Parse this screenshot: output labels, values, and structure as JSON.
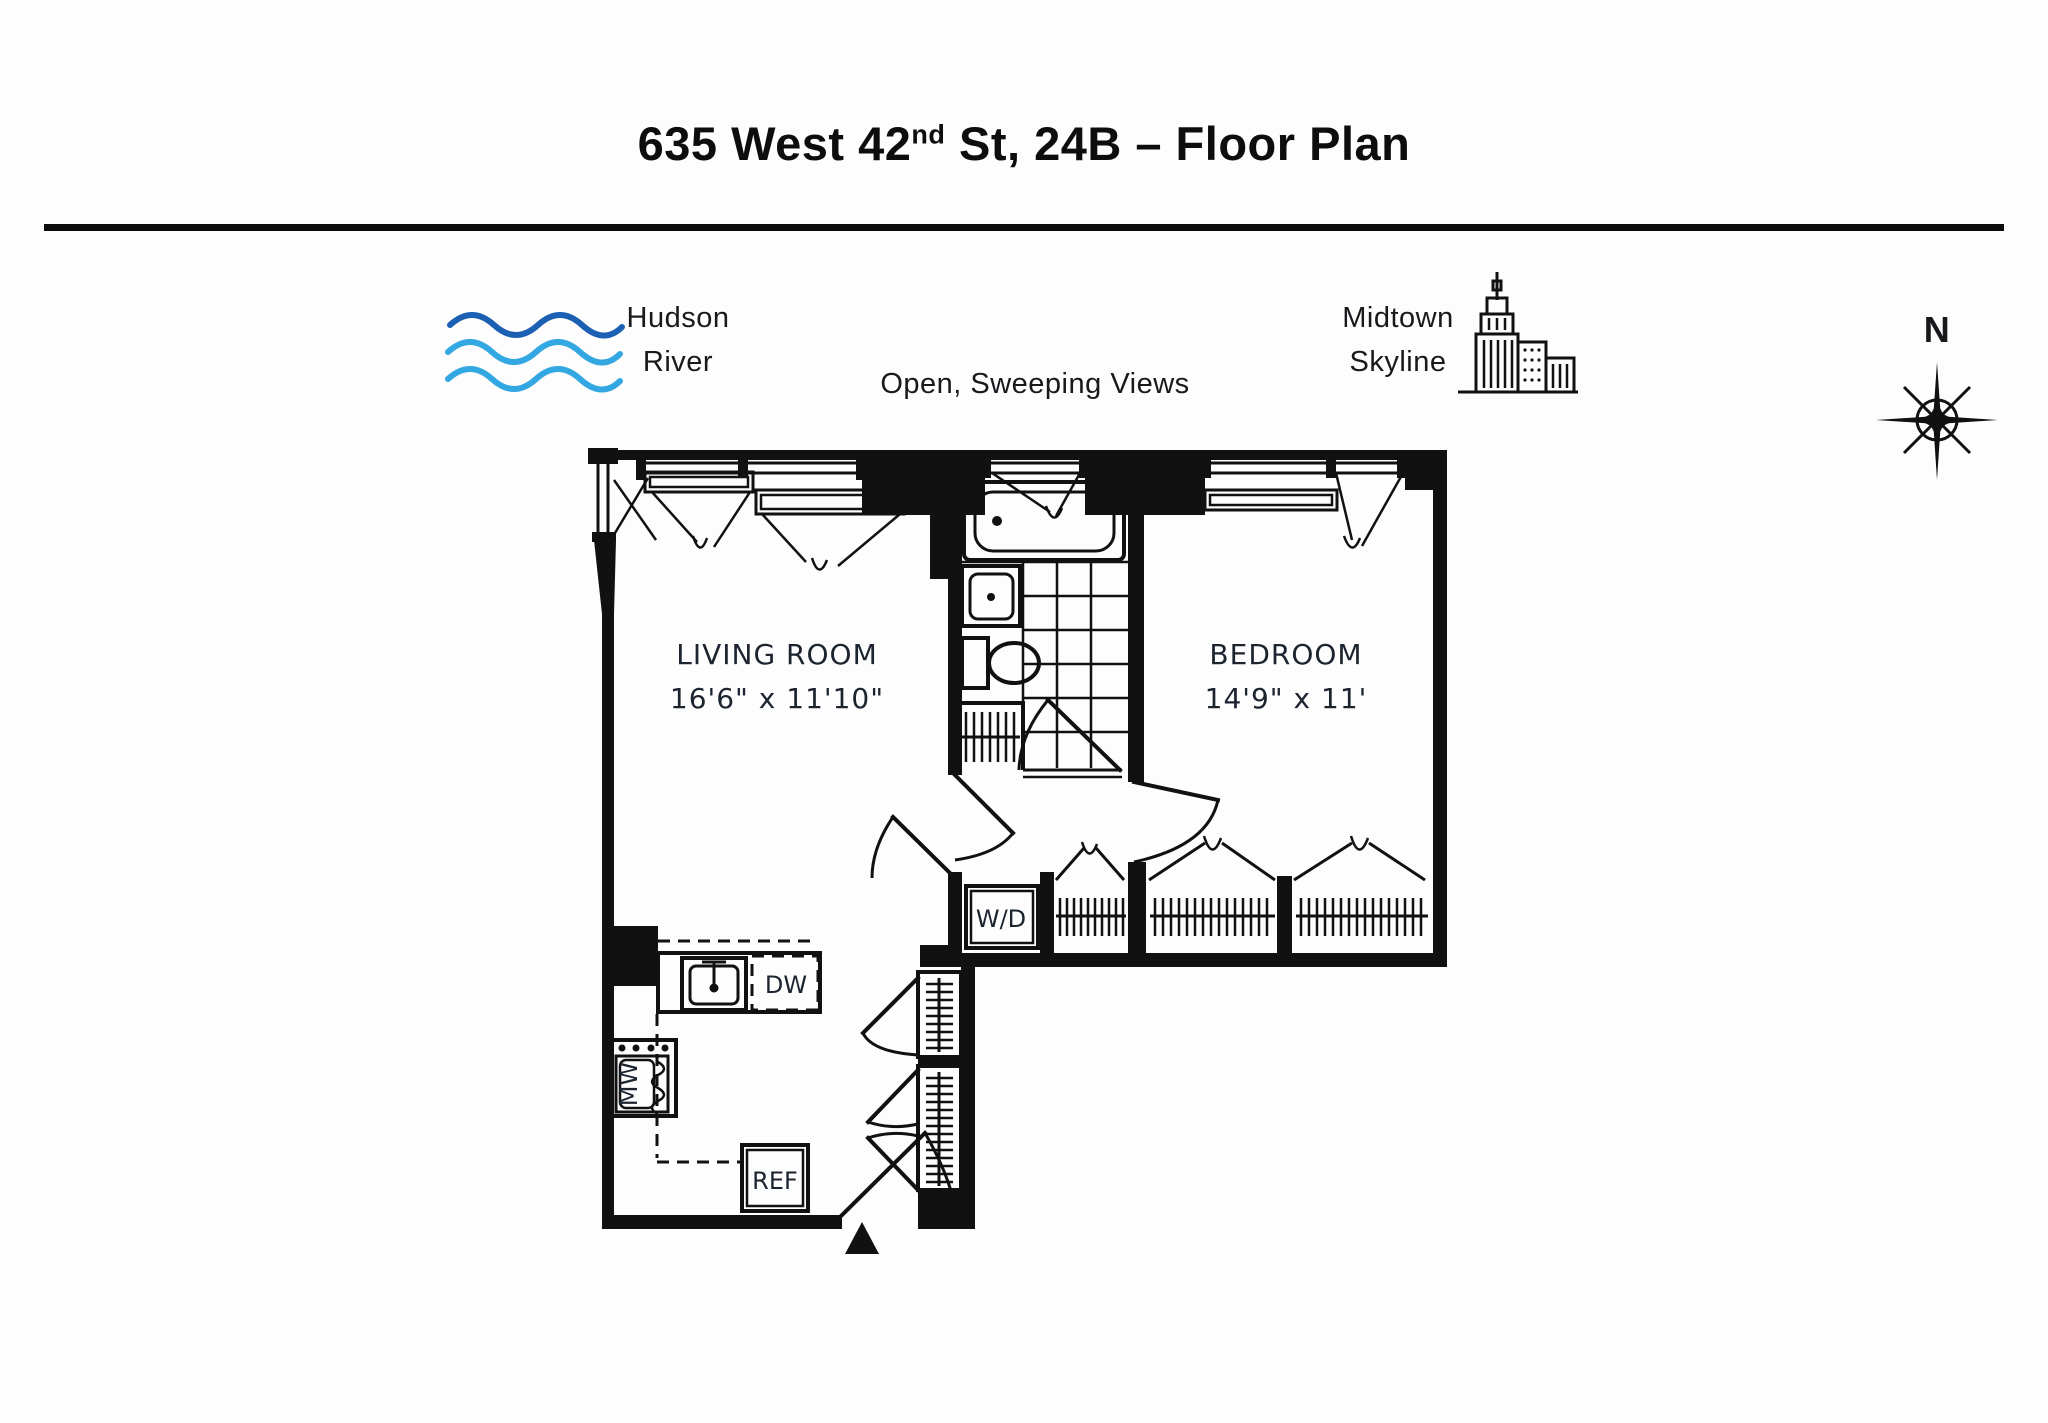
{
  "header": {
    "title_prefix": "635 West 42",
    "title_sup": "nd",
    "title_suffix": " St, 24B – Floor Plan"
  },
  "annotations": {
    "hudson_line1": "Hudson",
    "hudson_line2": "River",
    "views": "Open, Sweeping Views",
    "midtown_line1": "Midtown",
    "midtown_line2": "Skyline",
    "compass_n": "N"
  },
  "rooms": {
    "living_name": "LIVING ROOM",
    "living_dims": "16'6\" x 11'10\"",
    "bedroom_name": "BEDROOM",
    "bedroom_dims": "14'9\" x 11'"
  },
  "labels": {
    "wd": "W/D",
    "dw": "DW",
    "ref": "REF",
    "mw": "MW"
  },
  "colors": {
    "ink": "#111111",
    "label_ink": "#1c2430",
    "wave_dark": "#1c60b4",
    "wave_light": "#33a7e2"
  }
}
